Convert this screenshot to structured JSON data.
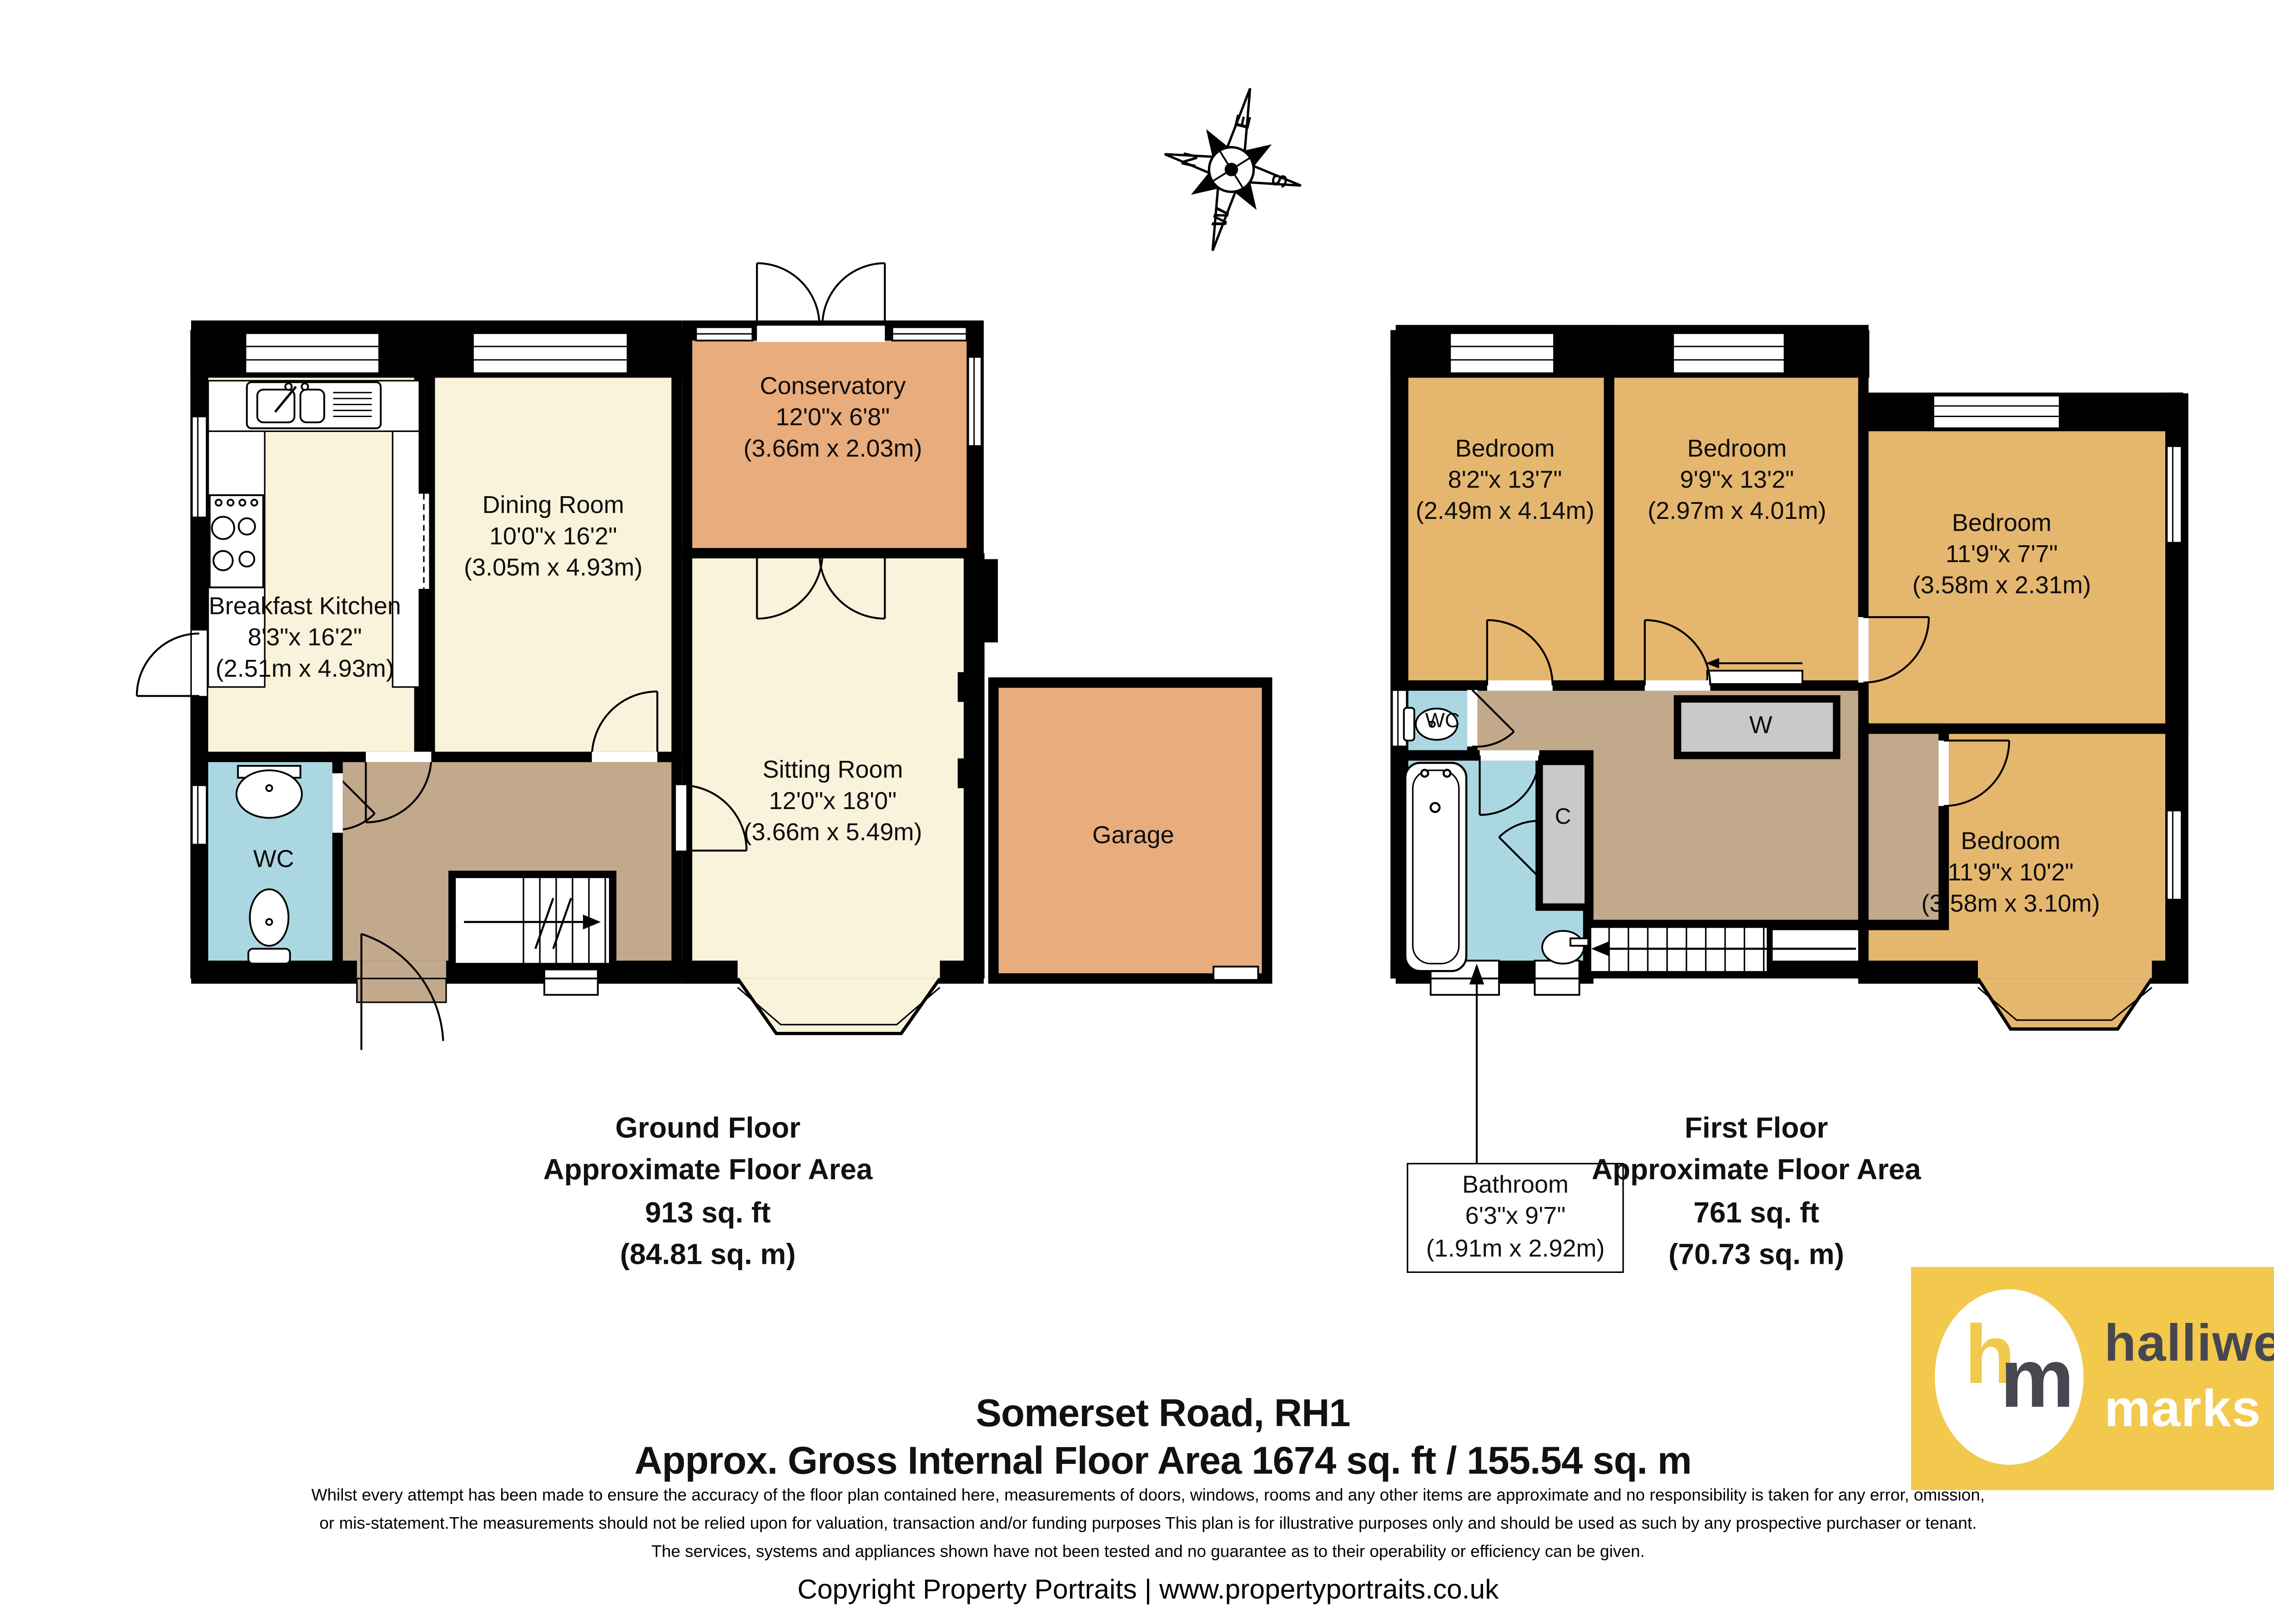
{
  "compass": {
    "north": "N",
    "east": "E",
    "south": "S",
    "west": "W"
  },
  "ground_floor": {
    "rooms": {
      "kitchen": {
        "name": "Breakfast Kitchen",
        "dims_imperial": "8'3\"x 16'2\"",
        "dims_metric": "(2.51m x 4.93m)"
      },
      "dining": {
        "name": "Dining Room",
        "dims_imperial": "10'0\"x 16'2\"",
        "dims_metric": "(3.05m x 4.93m)"
      },
      "conservatory": {
        "name": "Conservatory",
        "dims_imperial": "12'0\"x 6'8\"",
        "dims_metric": "(3.66m x 2.03m)"
      },
      "sitting": {
        "name": "Sitting Room",
        "dims_imperial": "12'0\"x 18'0\"",
        "dims_metric": "(3.66m x 5.49m)"
      },
      "wc": {
        "name": "WC"
      },
      "garage": {
        "name": "Garage"
      }
    },
    "summary": {
      "line1": "Ground Floor",
      "line2": "Approximate Floor Area",
      "line3": "913 sq. ft",
      "line4": "(84.81 sq. m)"
    }
  },
  "first_floor": {
    "rooms": {
      "bedroom1": {
        "name": "Bedroom",
        "dims_imperial": "8'2\"x 13'7\"",
        "dims_metric": "(2.49m x 4.14m)"
      },
      "bedroom2": {
        "name": "Bedroom",
        "dims_imperial": "9'9\"x 13'2\"",
        "dims_metric": "(2.97m x 4.01m)"
      },
      "bedroom3": {
        "name": "Bedroom",
        "dims_imperial": "11'9\"x 7'7\"",
        "dims_metric": "(3.58m x 2.31m)"
      },
      "bedroom4": {
        "name": "Bedroom",
        "dims_imperial": "11'9\"x 10'2\"",
        "dims_metric": "(3.58m x 3.10m)"
      },
      "wc": {
        "name": "WC"
      },
      "wardrobe": {
        "abbr": "W"
      },
      "cupboard": {
        "abbr": "C"
      },
      "bathroom": {
        "name": "Bathroom",
        "dims_imperial": "6'3\"x 9'7\"",
        "dims_metric": "(1.91m x 2.92m)"
      }
    },
    "summary": {
      "line1": "First Floor",
      "line2": "Approximate Floor Area",
      "line3": "761 sq. ft",
      "line4": "(70.73 sq. m)"
    }
  },
  "footer": {
    "address": "Somerset Road, RH1",
    "area_line": "Approx. Gross Internal Floor Area 1674 sq. ft / 155.54 sq. m",
    "disclaimer_line1": "Whilst every attempt has been made to ensure the accuracy of the floor plan contained here, measurements of doors, windows, rooms and any other items are approximate and no responsibility is taken for any error, omission,",
    "disclaimer_line2": "or mis-statement.The measurements should not be relied upon for valuation, transaction and/or funding purposes This plan is for illustrative purposes only and should be used as such by any prospective purchaser or tenant.",
    "disclaimer_line3": "The services, systems and appliances shown have not been tested and no guarantee as to their operability or efficiency can be given.",
    "copyright": "Copyright Property Portraits | www.propertyportraits.co.uk"
  },
  "logo": {
    "monogram_h": "h",
    "monogram_m": "m",
    "name_line1": "halliwell",
    "name_line2": "marks",
    "background_color": "#F2C94C",
    "text_color": "#474750"
  },
  "palette": {
    "room_cream": "#FAF3DB",
    "room_orange": "#E9AC7C",
    "room_gold": "#E5B66E",
    "room_blue": "#ABD7E2",
    "hall_brown": "#C2A98C",
    "cupboard_grey": "#C9C9C9",
    "wall": "#000000"
  }
}
